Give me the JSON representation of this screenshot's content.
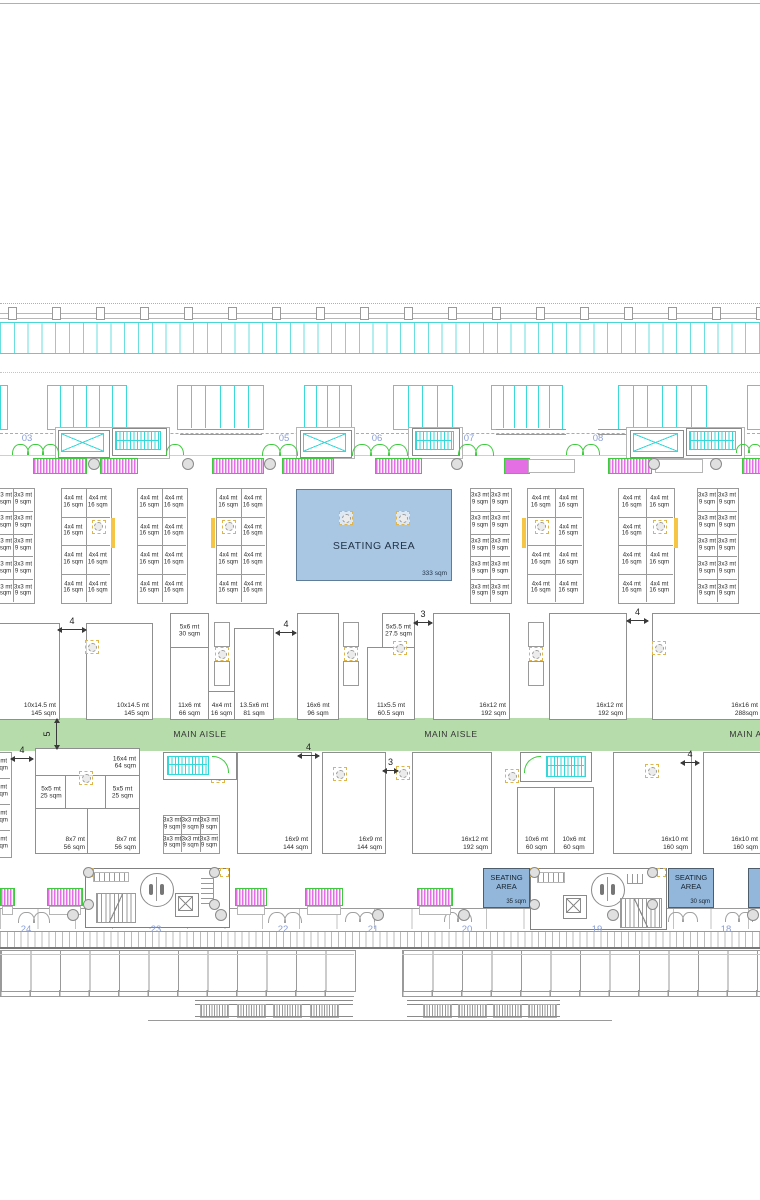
{
  "document": {
    "type": "exhibition-hall-floor-plan"
  },
  "colors": {
    "cyan": "#35d8d8",
    "magenta": "#e46ee4",
    "green": "#3ecb3e",
    "aisle_green": "#b7dcab",
    "seating_fill": "#a9c6e3",
    "seating_small_fill": "#93b7da",
    "yellow": "#f6c545",
    "grid_label_blue": "#8b9fd6",
    "line_gray": "#9a9a9a"
  },
  "aisle": {
    "label": "MAIN AISLE",
    "label_x": [
      200,
      451,
      756
    ],
    "width_dim": "5"
  },
  "grid_labels": {
    "top": [
      {
        "label": "03",
        "x": 27
      },
      {
        "label": "04",
        "x": 155
      },
      {
        "label": "05",
        "x": 284
      },
      {
        "label": "06",
        "x": 377
      },
      {
        "label": "07",
        "x": 469
      },
      {
        "label": "08",
        "x": 598
      },
      {
        "label": "09",
        "x": 727
      }
    ],
    "bottom": [
      {
        "label": "24",
        "x": 26
      },
      {
        "label": "23",
        "x": 156
      },
      {
        "label": "22",
        "x": 283
      },
      {
        "label": "21",
        "x": 373
      },
      {
        "label": "20",
        "x": 467
      },
      {
        "label": "19",
        "x": 597
      },
      {
        "label": "18",
        "x": 726
      }
    ]
  },
  "seating_main": {
    "label": "SEATING AREA",
    "area": "333 sqm",
    "columns": [
      [
        345,
        517
      ],
      [
        402,
        517
      ]
    ]
  },
  "seating_small": [
    {
      "label": "SEATING AREA",
      "area": "35 sqm",
      "x": 483,
      "y": 868,
      "w": 45,
      "h": 38
    },
    {
      "label": "SEATING AREA",
      "area": "30 sqm",
      "x": 668,
      "y": 868,
      "w": 44,
      "h": 38
    },
    {
      "label": "",
      "area": "",
      "x": 748,
      "y": 868,
      "w": 12,
      "h": 38
    }
  ],
  "cell_grids": [
    {
      "x": -7,
      "y": 488,
      "cols": 2,
      "cw": 20,
      "rows": 5,
      "rh": 22.8,
      "l1": "3x3 mt",
      "l2": "9 sqm"
    },
    {
      "x": 61,
      "y": 488,
      "cols": 2,
      "cw": 24.5,
      "rows": 4,
      "rh": 28.5,
      "l1": "4x4 mt",
      "l2": "16 sqm",
      "sym_col": 1,
      "yellow": "right"
    },
    {
      "x": 137,
      "y": 488,
      "cols": 2,
      "cw": 24.5,
      "rows": 4,
      "rh": 28.5,
      "l1": "4x4 mt",
      "l2": "16 sqm"
    },
    {
      "x": 216,
      "y": 488,
      "cols": 2,
      "cw": 24.5,
      "rows": 4,
      "rh": 28.5,
      "l1": "4x4 mt",
      "l2": "16 sqm",
      "sym_col": 0,
      "yellow": "left"
    },
    {
      "x": 470,
      "y": 488,
      "cols": 2,
      "cw": 20,
      "rows": 5,
      "rh": 22.8,
      "l1": "3x3 mt",
      "l2": "9 sqm"
    },
    {
      "x": 527,
      "y": 488,
      "cols": 2,
      "cw": 27.5,
      "rows": 4,
      "rh": 28.5,
      "l1": "4x4 mt",
      "l2": "16 sqm",
      "sym_col": 0,
      "yellow": "left"
    },
    {
      "x": 618,
      "y": 488,
      "cols": 2,
      "cw": 27.5,
      "rows": 4,
      "rh": 28.5,
      "l1": "4x4 mt",
      "l2": "16 sqm",
      "sym_col": 1,
      "yellow": "right"
    },
    {
      "x": 697,
      "y": 488,
      "cols": 2,
      "cw": 20,
      "rows": 5,
      "rh": 22.8,
      "l1": "3x3 mt",
      "l2": "9 sqm"
    },
    {
      "x": 163,
      "y": 815,
      "cols": 3,
      "cw": 18.4,
      "rows": 2,
      "rh": 18.5,
      "l1": "3x3 mt",
      "l2": "9 sqm"
    },
    {
      "x": -14,
      "y": 752,
      "cols": 1,
      "cw": 24,
      "rows": 4,
      "rh": 26,
      "l1": "4x4 mt",
      "l2": "16 sqm"
    }
  ],
  "booths": [
    {
      "l1": "10x14.5 mt",
      "l2": "145 sqm",
      "x": -20,
      "y": 623,
      "w": 78,
      "h": 95,
      "pos": "br"
    },
    {
      "l1": "10x14.5 mt",
      "l2": "145 sqm",
      "x": 86,
      "y": 623,
      "w": 65,
      "h": 95,
      "pos": "br"
    },
    {
      "l1": "5x6 mt",
      "l2": "30 sqm",
      "x": 170,
      "y": 613,
      "w": 37,
      "h": 34,
      "pos": "c"
    },
    {
      "l1": "11x6 mt",
      "l2": "66 sqm",
      "x": 170,
      "y": 647,
      "w": 37,
      "h": 71,
      "pos": "bc"
    },
    {
      "l1": "4x4 mt",
      "l2": "16 sqm",
      "x": 208,
      "y": 691,
      "w": 25,
      "h": 27,
      "pos": "bc"
    },
    {
      "l1": "13.5x6 mt",
      "l2": "81 sqm",
      "x": 234,
      "y": 628,
      "w": 38,
      "h": 90,
      "pos": "bc"
    },
    {
      "l1": "16x6 mt",
      "l2": "96 sqm",
      "x": 297,
      "y": 613,
      "w": 40,
      "h": 105,
      "pos": "bc"
    },
    {
      "l1": "5x5.5 mt",
      "l2": "27.5 sqm",
      "x": 382,
      "y": 613,
      "w": 31,
      "h": 34,
      "pos": "c"
    },
    {
      "l1": "11x5.5 mt",
      "l2": "60.5 sqm",
      "x": 367,
      "y": 647,
      "w": 46,
      "h": 71,
      "pos": "bc"
    },
    {
      "l1": "16x12 mt",
      "l2": "192 sqm",
      "x": 433,
      "y": 613,
      "w": 75,
      "h": 105,
      "pos": "br"
    },
    {
      "l1": "16x12 mt",
      "l2": "192 sqm",
      "x": 549,
      "y": 613,
      "w": 76,
      "h": 105,
      "pos": "br"
    },
    {
      "l1": "16x16 mt",
      "l2": "288sqm",
      "x": 652,
      "y": 613,
      "w": 108,
      "h": 105,
      "pos": "br"
    },
    {
      "l1": "16x4 mt",
      "l2": "64 sqm",
      "x": 35,
      "y": 748,
      "w": 103,
      "h": 27,
      "pos": "rc"
    },
    {
      "l1": "5x5 mt",
      "l2": "25 sqm",
      "x": 35,
      "y": 775,
      "w": 30,
      "h": 33,
      "pos": "c"
    },
    {
      "l1": "",
      "l2": "",
      "x": 65,
      "y": 775,
      "w": 40,
      "h": 33,
      "pos": "c"
    },
    {
      "l1": "5x5 mt",
      "l2": "25 sqm",
      "x": 105,
      "y": 775,
      "w": 33,
      "h": 33,
      "pos": "c"
    },
    {
      "l1": "8x7 mt",
      "l2": "56 sqm",
      "x": 35,
      "y": 808,
      "w": 52,
      "h": 44,
      "pos": "br"
    },
    {
      "l1": "8x7 mt",
      "l2": "56 sqm",
      "x": 87,
      "y": 808,
      "w": 51,
      "h": 44,
      "pos": "br"
    },
    {
      "l1": "16x9 mt",
      "l2": "144 sqm",
      "x": 237,
      "y": 752,
      "w": 73,
      "h": 100,
      "pos": "br"
    },
    {
      "l1": "16x9 mt",
      "l2": "144 sqm",
      "x": 322,
      "y": 752,
      "w": 62,
      "h": 100,
      "pos": "br"
    },
    {
      "l1": "16x12 mt",
      "l2": "192 sqm",
      "x": 412,
      "y": 752,
      "w": 78,
      "h": 100,
      "pos": "br"
    },
    {
      "l1": "10x6 mt",
      "l2": "60 sqm",
      "x": 517,
      "y": 787,
      "w": 37,
      "h": 65,
      "pos": "bc"
    },
    {
      "l1": "10x6 mt",
      "l2": "60 sqm",
      "x": 554,
      "y": 787,
      "w": 38,
      "h": 65,
      "pos": "bc"
    },
    {
      "l1": "16x10 mt",
      "l2": "160 sqm",
      "x": 613,
      "y": 752,
      "w": 77,
      "h": 100,
      "pos": "br"
    },
    {
      "l1": "16x10 mt",
      "l2": "160 sqm",
      "x": 703,
      "y": 752,
      "w": 57,
      "h": 100,
      "pos": "br"
    }
  ],
  "dims": [
    {
      "t": "4",
      "x": 58,
      "w": 28,
      "y": 629
    },
    {
      "t": "4",
      "x": 276,
      "w": 20,
      "y": 632
    },
    {
      "t": "3",
      "x": 414,
      "w": 18,
      "y": 622
    },
    {
      "t": "4",
      "x": 627,
      "w": 21,
      "y": 620
    },
    {
      "t": "4",
      "x": 11,
      "w": 22,
      "y": 758
    },
    {
      "t": "4",
      "x": 298,
      "w": 21,
      "y": 755
    },
    {
      "t": "3",
      "x": 383,
      "w": 15,
      "y": 770
    },
    {
      "t": "4",
      "x": 681,
      "w": 18,
      "y": 762
    }
  ],
  "v_dim": {
    "t": "5",
    "x": 56,
    "y": 719,
    "h": 30
  },
  "columns": [
    [
      91,
      646
    ],
    [
      399,
      647
    ],
    [
      658,
      647
    ],
    [
      85,
      777
    ],
    [
      217,
      775
    ],
    [
      339,
      773
    ],
    [
      402,
      772
    ],
    [
      511,
      775
    ],
    [
      651,
      770
    ]
  ],
  "clusters": [
    [
      214,
      622
    ],
    [
      343,
      622
    ],
    [
      528,
      622
    ]
  ],
  "plain_circles_top": [
    [
      93,
      463
    ],
    [
      187,
      463
    ],
    [
      269,
      463
    ],
    [
      456,
      463
    ],
    [
      653,
      463
    ],
    [
      715,
      463
    ]
  ],
  "plain_circles_cores": [
    [
      87,
      871
    ],
    [
      213,
      871
    ],
    [
      87,
      903
    ],
    [
      213,
      903
    ],
    [
      533,
      871
    ],
    [
      651,
      871
    ],
    [
      533,
      903
    ],
    [
      651,
      903
    ]
  ],
  "plain_circles_colonnade": [
    [
      72,
      914
    ],
    [
      220,
      914
    ],
    [
      377,
      914
    ],
    [
      463,
      914
    ],
    [
      612,
      914
    ],
    [
      752,
      914
    ]
  ],
  "skylights": [
    {
      "x": 0,
      "w": 6,
      "p": 1
    },
    {
      "x": 47,
      "w": 78,
      "p": 6
    },
    {
      "x": 177,
      "w": 85,
      "p": 6
    },
    {
      "x": 304,
      "w": 46,
      "p": 4
    },
    {
      "x": 393,
      "w": 58,
      "p": 4
    },
    {
      "x": 491,
      "w": 70,
      "p": 6
    },
    {
      "x": 618,
      "w": 87,
      "p": 6
    },
    {
      "x": 747,
      "w": 13,
      "p": 1
    }
  ],
  "elevators_top": [
    {
      "x": 58,
      "w": 50
    },
    {
      "x": 300,
      "w": 50
    },
    {
      "x": 630,
      "w": 52
    }
  ],
  "escalators_top": [
    {
      "x": 112,
      "w": 53
    },
    {
      "x": 412,
      "w": 46
    },
    {
      "x": 686,
      "w": 54
    }
  ],
  "core_outlines_top": [
    {
      "x": 55,
      "w": 113
    },
    {
      "x": 296,
      "w": 57
    },
    {
      "x": 408,
      "w": 53
    },
    {
      "x": 626,
      "w": 117
    }
  ],
  "canopies": [
    {
      "x": 180,
      "w": 82
    },
    {
      "x": 496,
      "w": 70
    },
    {
      "x": 598,
      "w": 28
    }
  ],
  "arc_groups_top": [
    {
      "x": 12,
      "n": 3,
      "aw": 15
    },
    {
      "x": 166,
      "n": 1,
      "aw": 16
    },
    {
      "x": 262,
      "n": 2,
      "aw": 17
    },
    {
      "x": 352,
      "n": 3,
      "aw": 18
    },
    {
      "x": 458,
      "n": 2,
      "aw": 17
    },
    {
      "x": 566,
      "n": 2,
      "aw": 16
    },
    {
      "x": 736,
      "n": 2,
      "aw": 12
    }
  ],
  "arc_groups_bottom": [
    {
      "x": 18,
      "n": 2,
      "aw": 15
    },
    {
      "x": 268,
      "n": 2,
      "aw": 16
    },
    {
      "x": 345,
      "n": 2,
      "aw": 14
    },
    {
      "x": 444,
      "n": 2,
      "aw": 13
    },
    {
      "x": 668,
      "n": 2,
      "aw": 14
    },
    {
      "x": 725,
      "n": 2,
      "aw": 13
    }
  ],
  "benches_top": [
    {
      "x": 33,
      "w": 52
    },
    {
      "x": 100,
      "w": 36
    },
    {
      "x": 212,
      "w": 50
    },
    {
      "x": 282,
      "w": 50
    },
    {
      "x": 375,
      "w": 45
    },
    {
      "x": 504,
      "w": 24,
      "solid": true
    },
    {
      "x": 608,
      "w": 42
    },
    {
      "x": 742,
      "w": 18
    }
  ],
  "benches_top_gray": [
    {
      "x": 528,
      "w": 45
    },
    {
      "x": 655,
      "w": 46
    }
  ],
  "benches_bottom": [
    {
      "x": 0,
      "w": 13
    },
    {
      "x": 47,
      "w": 34
    },
    {
      "x": 235,
      "w": 30
    },
    {
      "x": 305,
      "w": 36
    },
    {
      "x": 417,
      "w": 34
    }
  ]
}
